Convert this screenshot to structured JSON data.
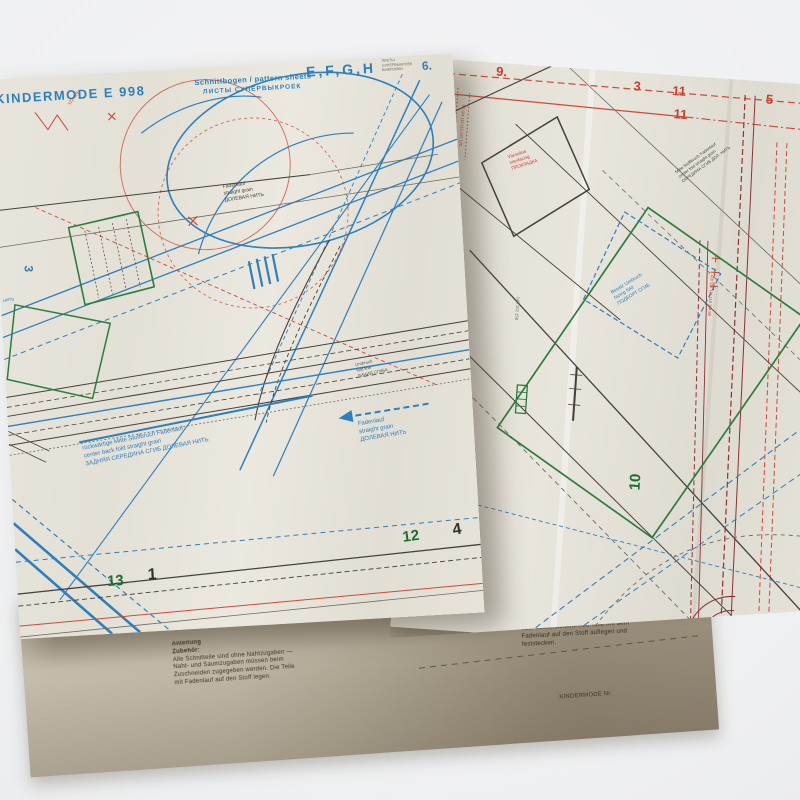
{
  "sheet_left": {
    "header": {
      "brand": "KINDERMODE E 998",
      "subtitle": "Schnittbogen / pattern sheets",
      "subtitle_ru": "ЛИСТЫ СУПЕРВЫКРОЕК",
      "letters": "E,F,G,H",
      "corner_note": [
        "ЛИСТЫ",
        "СУПЕРВЫКРОЕК",
        "ВЫКРОЙКИ"
      ]
    },
    "numbers": {
      "blue6": "6.",
      "blue3": "3",
      "green12": "12",
      "black4": "4",
      "green13": "13",
      "black1": "1"
    },
    "sizes_note": "122·128",
    "edge_note": "НИТЬ",
    "labels": {
      "grain": [
        "Fadenlauf",
        "straight grain",
        "ДОЛЕВАЯ НИТЬ"
      ],
      "fold": [
        "Umbruch",
        "fold line",
        "ЛИНИЯ СГИБА"
      ],
      "center_back": [
        "rückwärtige Mitte Stoffbruch Fadenlauf",
        "center back fold straight grain",
        "ЗАДНЯЯ СЕРЕДИНА СГИБ ДОЛЕВАЯ НИТЬ"
      ],
      "arrow_grain": [
        "Fadenlauf",
        "straight grain",
        "ДОЛЕВАЯ НИТЬ"
      ]
    }
  },
  "sheet_right": {
    "numbers": {
      "red9": "9.",
      "red3": "3",
      "red11a": "11",
      "red5": "5",
      "red11b": "11",
      "green10": "10"
    },
    "labels": {
      "diamond": [
        "Vlieseline",
        "interfacing",
        "ПРОКЛАДКА"
      ],
      "fold_diag": [
        "Mitte Stoffbruch Fadenlauf",
        "center fold straight grain",
        "СЕРЕДИНА СГИБ ДОЛ. НИТЬ"
      ],
      "facing": [
        "Besatz Umbruch",
        "facing fold",
        "ПОДБОРТ СГИБ"
      ],
      "sizes_a": "98 104 110 116 122 128",
      "sizes_b": "98 104 110 116 122 128",
      "sizes_gray": "146 152 158",
      "sizes_red_v": "128 122 116 110 104 98"
    }
  },
  "sheet_bottom": {
    "caption": "KINDERMODE Nr.",
    "fineprint_left": [
      "Anleitung",
      "Zubehör:",
      "Alle Schnitteile sind ohne Nahtzugaben —",
      "Naht- und Saumzugaben müssen beim",
      "Zuschneiden zugegeben werden. Die Teile",
      "mit Fadenlauf auf den Stoff legen."
    ],
    "fineprint_right": [
      "Vor dem Ausschneiden der Schnitteile die",
      "benötigte Größe heraussuchen und die",
      "Teile mit Seidenpapier durchpausen",
      "oder ausschneiden. Alle Teile mit dem",
      "Fadenlauf auf den Stoff auflegen und",
      "feststecken."
    ]
  },
  "colors": {
    "blue": "#2e7fbe",
    "red": "#cd4a38",
    "dark_red": "#8f3134",
    "green": "#2b7d3e",
    "ink": "#46413a",
    "sheet": "#e6e3da"
  }
}
